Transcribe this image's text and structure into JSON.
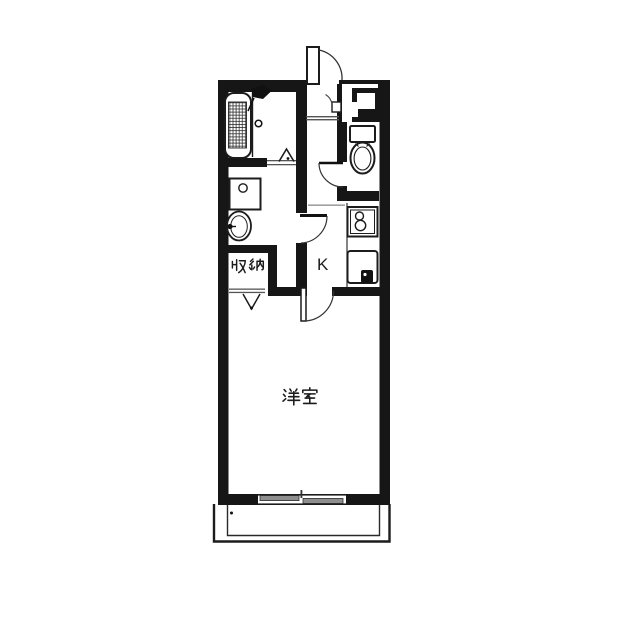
{
  "image_type": "apartment-floor-plan",
  "labels": {
    "storage": "収納",
    "kitchen": "K",
    "western_room": "洋室"
  },
  "rooms": [
    {
      "id": "bathroom",
      "label": "",
      "fixtures": [
        "bathtub",
        "shower-head"
      ]
    },
    {
      "id": "washroom",
      "label": "",
      "fixtures": [
        "washing-machine-pan",
        "washbasin"
      ]
    },
    {
      "id": "storage",
      "label": "収納",
      "fixtures": []
    },
    {
      "id": "kitchen",
      "label": "K",
      "fixtures": [
        "two-burner-stove",
        "kitchen-sink"
      ]
    },
    {
      "id": "toilet-room",
      "label": "",
      "fixtures": [
        "toilet"
      ]
    },
    {
      "id": "western-room",
      "label": "洋室",
      "fixtures": []
    },
    {
      "id": "entrance",
      "label": "",
      "fixtures": [
        "entrance-door",
        "shoe-cabinet"
      ]
    },
    {
      "id": "balcony",
      "label": "",
      "fixtures": [
        "sliding-window"
      ]
    }
  ],
  "doors": [
    "entrance-swing-door",
    "bathroom-folding-door",
    "washroom-swing-door",
    "toilet-swing-door",
    "western-room-swing-door",
    "storage-bifold-door"
  ],
  "colors": {
    "wall": "#161616",
    "background": "#ffffff",
    "stroke": "#222222",
    "window_pane": "#8e8e8e",
    "threshold": "#666666"
  }
}
